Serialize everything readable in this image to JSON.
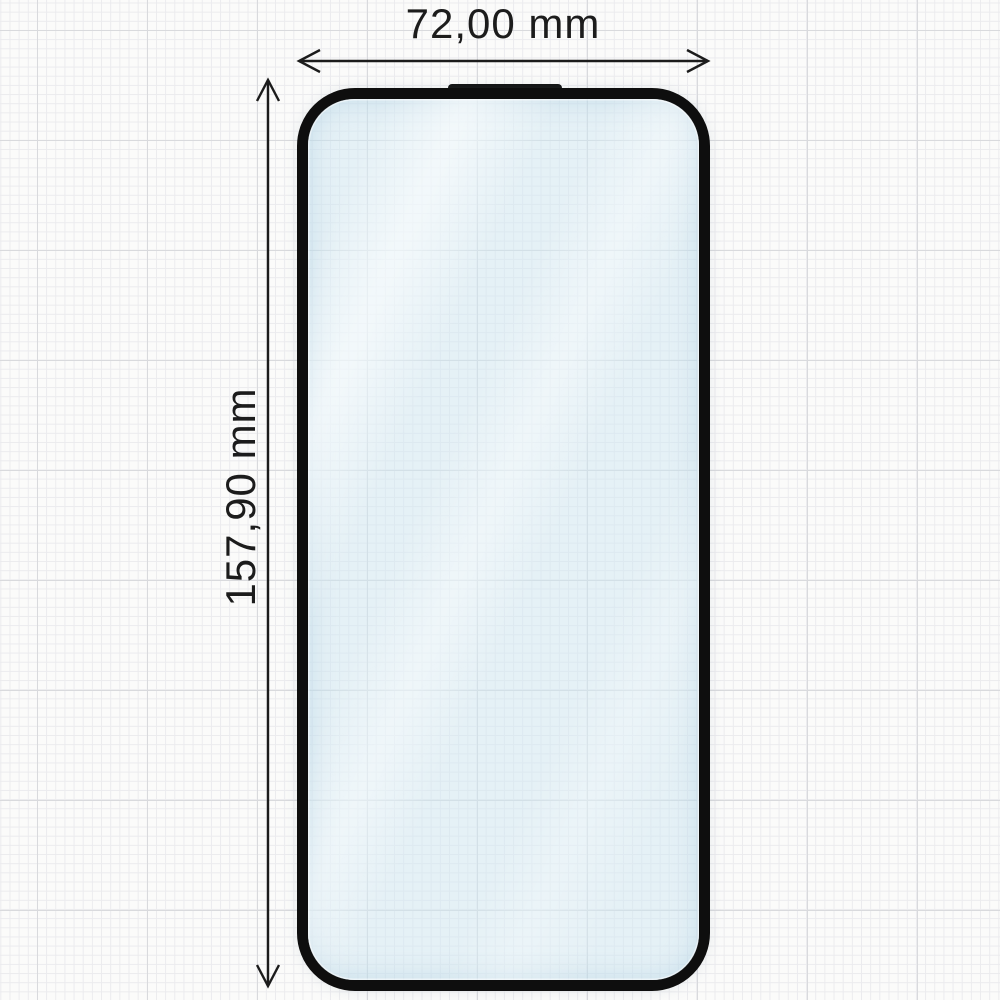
{
  "diagram": {
    "type": "product-dimension-diagram",
    "subject": "tempered-glass-screen-protector",
    "width_dimension": {
      "label": "72,00 mm",
      "value_mm": 72.0,
      "orientation": "horizontal"
    },
    "height_dimension": {
      "label": "157,90 mm",
      "value_mm": 157.9,
      "orientation": "vertical"
    }
  },
  "colors": {
    "paper": "#fbfbfa",
    "grid_minor": "#ebebee",
    "grid_major": "#d9dadd",
    "frame": "#0e0e0e",
    "glass_tint": "#e8f2f7",
    "dimension": "#1c1c1c"
  }
}
